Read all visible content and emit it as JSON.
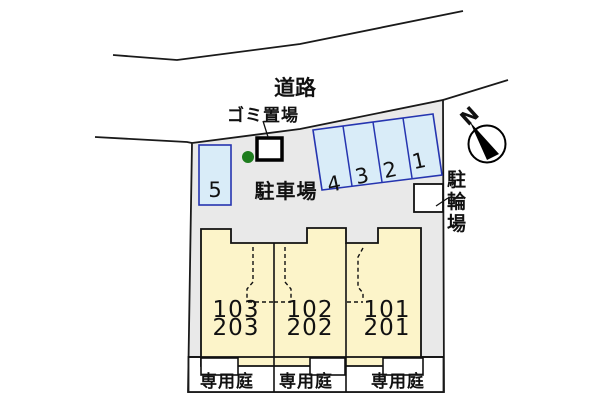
{
  "plan": {
    "road_label": "道路",
    "garbage_label": "ゴミ置場",
    "parking_label": "駐車場",
    "bicycle_label": "駐輪場",
    "north_label": "N",
    "parking_spaces": {
      "slanted": [
        "4",
        "3",
        "2",
        "1"
      ],
      "vertical": [
        "5"
      ]
    },
    "units": [
      {
        "lower": "103",
        "upper": "203"
      },
      {
        "lower": "102",
        "upper": "202"
      },
      {
        "lower": "101",
        "upper": "201"
      }
    ],
    "garden_labels": [
      "専用庭",
      "専用庭",
      "専用庭"
    ],
    "colors": {
      "site_fill": "#e9e9e9",
      "building_fill": "#fcf4c9",
      "parking_space_fill": "#d9ecf8",
      "parking_space_border": "#2635b0",
      "garden_fill": "#ffffff",
      "garbage_dot": "#1e7d1e",
      "line": "#1a1a1a"
    }
  }
}
